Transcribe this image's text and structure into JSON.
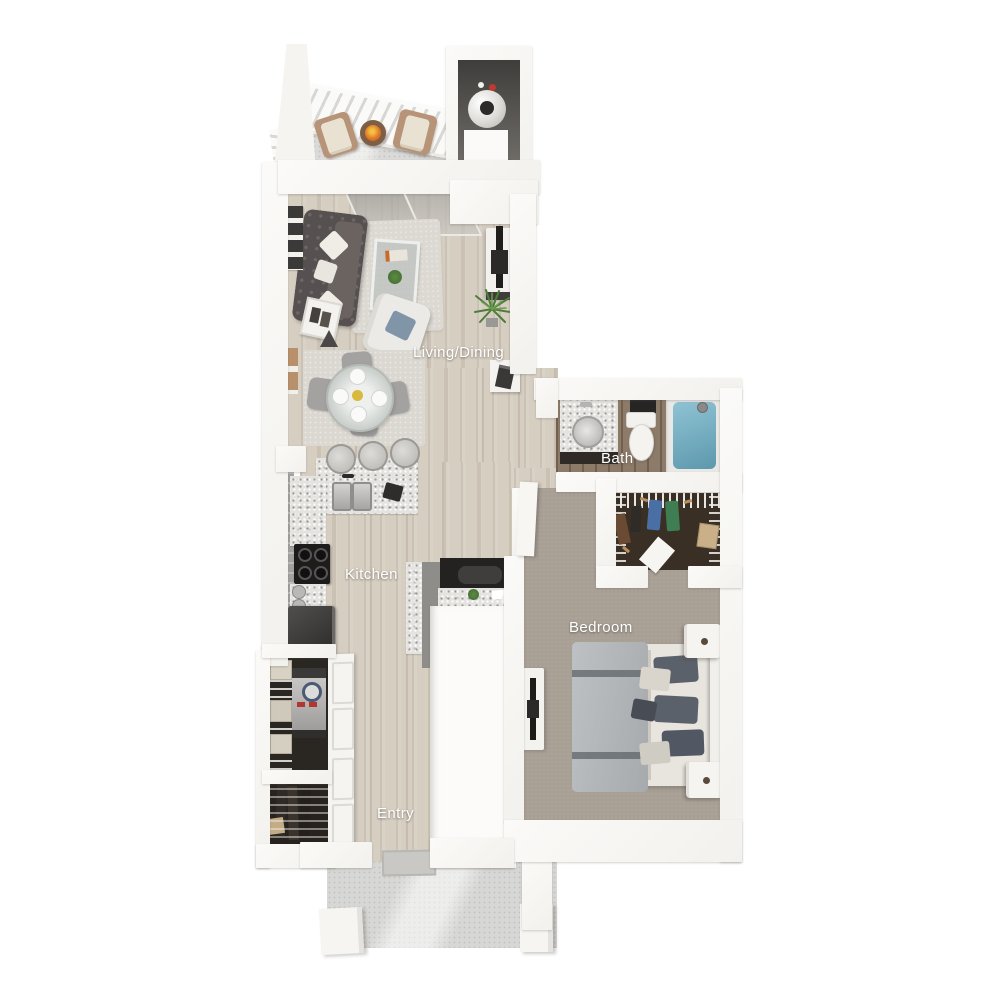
{
  "plan": {
    "title": "One-bedroom apartment 3D floor plan, top-down view",
    "labels": {
      "living": "Living/Dining",
      "bath": "Bath",
      "kitchen": "Kitchen",
      "bedroom": "Bedroom",
      "entry": "Entry"
    },
    "colors": {
      "background": "#ffffff",
      "wall": "#f7f6f3",
      "wood_floor": "#d6cec1",
      "bath_floor": "#8d7b69",
      "carpet": "#a89f95",
      "closet_floor": "#3a2f25",
      "concrete": "#d7d7d5",
      "granite": "#e4e3e0",
      "sofa": "#575050",
      "bathtub": "#71aabd",
      "fire": "#e0782a",
      "label_text": "#ffffff"
    },
    "rooms": [
      {
        "name": "balcony",
        "furniture": [
          "patio-chair",
          "patio-chair",
          "fire-table",
          "railing"
        ]
      },
      {
        "name": "water-heater-closet",
        "furniture": [
          "water-heater",
          "storage-box"
        ]
      },
      {
        "name": "living-dining",
        "furniture": [
          "sofa",
          "coffee-table",
          "armchair",
          "area-rug",
          "tv-console",
          "tv",
          "floor-plant",
          "wall-art",
          "side-table",
          "floor-lamp",
          "dining-table",
          "dining-chairs",
          "sliding-glass-door"
        ]
      },
      {
        "name": "kitchen",
        "furniture": [
          "double-sink",
          "stove",
          "refrigerator",
          "bar-stools",
          "granite-counters",
          "desk-nook"
        ]
      },
      {
        "name": "bath",
        "furniture": [
          "vanity-sink",
          "toilet",
          "bathtub",
          "shower-head"
        ]
      },
      {
        "name": "walk-in-closet",
        "furniture": [
          "wire-shelving",
          "hanging-clothes"
        ]
      },
      {
        "name": "bedroom",
        "furniture": [
          "bed",
          "nightstand",
          "nightstand",
          "tv-console",
          "tv"
        ]
      },
      {
        "name": "laundry-closet",
        "furniture": [
          "washer-dryer",
          "wire-shelving",
          "baskets"
        ]
      },
      {
        "name": "coat-closet",
        "furniture": [
          "wire-shelving",
          "hanging-clothes"
        ]
      },
      {
        "name": "entry",
        "furniture": [
          "doormat",
          "entry-door"
        ]
      },
      {
        "name": "porch",
        "furniture": [
          "pillar",
          "pillar"
        ]
      }
    ]
  }
}
